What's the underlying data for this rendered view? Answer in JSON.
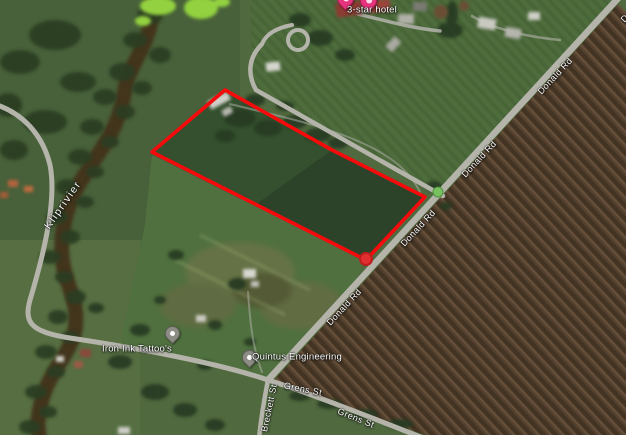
{
  "map": {
    "labels": {
      "hotel": {
        "text": "3-star hotel"
      },
      "river": {
        "text": "Kliprivier"
      },
      "donald_rd": {
        "text": "Donald Rd"
      },
      "grens_st": {
        "text": "Grens St"
      },
      "breckett_st": {
        "text": "Breckett St"
      },
      "tattoo": {
        "text": "Iron Ink Tattoo's"
      },
      "engineering": {
        "text": "Quintus Engineering"
      }
    },
    "markers": {
      "hotel_pin_color": "#e5347d",
      "poi_pin_color": "#8d8d86",
      "park_dot_color": "#77c25e",
      "park_dot_stroke": "#4e8f3e"
    }
  },
  "overlay": {
    "polygon_points": "225,90 332,150 425,197 366,260 152,152",
    "polygon_stroke": "#f50b0b",
    "polygon_stroke_width": "3.6",
    "vertex_dot_fill": "#e12f2f",
    "vertex_dot_stroke": "#c11d1d"
  }
}
